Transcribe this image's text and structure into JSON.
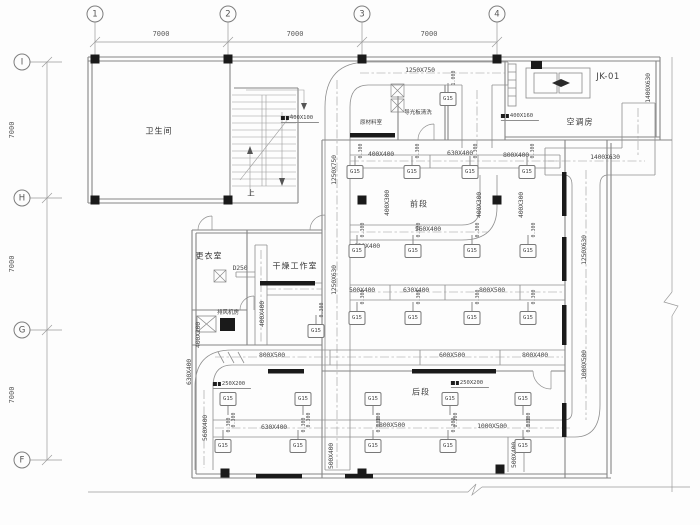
{
  "drawing": {
    "grid": {
      "top_bubbles": [
        {
          "label": "1",
          "x": 95
        },
        {
          "label": "2",
          "x": 228
        },
        {
          "label": "3",
          "x": 362
        },
        {
          "label": "4",
          "x": 497
        }
      ],
      "left_bubbles": [
        {
          "label": "I",
          "y": 62
        },
        {
          "label": "H",
          "y": 198
        },
        {
          "label": "G",
          "y": 330
        },
        {
          "label": "F",
          "y": 460
        }
      ],
      "top_dims": [
        {
          "text": "7000",
          "x": 161,
          "y": 34
        },
        {
          "text": "7000",
          "x": 295,
          "y": 34
        },
        {
          "text": "7000",
          "x": 429,
          "y": 34
        }
      ],
      "left_dims": [
        {
          "text": "7000",
          "x": 12,
          "y": 130
        },
        {
          "text": "7000",
          "x": 12,
          "y": 264
        },
        {
          "text": "7000",
          "x": 12,
          "y": 395
        }
      ]
    },
    "room_labels": [
      {
        "text": "卫生间",
        "x": 159,
        "y": 131,
        "small": false
      },
      {
        "text": "原材料室",
        "x": 371,
        "y": 122,
        "small": true
      },
      {
        "text": "导光板清洗",
        "x": 418,
        "y": 112,
        "small": true
      },
      {
        "text": "空调房",
        "x": 580,
        "y": 122,
        "small": false
      },
      {
        "text": "前段",
        "x": 419,
        "y": 204,
        "small": false
      },
      {
        "text": "更衣室",
        "x": 209,
        "y": 256,
        "small": false
      },
      {
        "text": "干燥工作室",
        "x": 295,
        "y": 266,
        "small": false
      },
      {
        "text": "后段",
        "x": 421,
        "y": 392,
        "small": false
      },
      {
        "text": "排风机房",
        "x": 228,
        "y": 312,
        "small": true
      }
    ],
    "equipment_labels": [
      {
        "text": "JK-01",
        "x": 608,
        "y": 77
      }
    ],
    "stair_label": {
      "text": "上",
      "x": 251,
      "y": 193
    },
    "duct_labels": [
      {
        "text": "1250X750",
        "x": 420,
        "y": 70,
        "rot": 0
      },
      {
        "text": "1250X750",
        "x": 334,
        "y": 170,
        "rot": -90
      },
      {
        "text": "1250X630",
        "x": 334,
        "y": 280,
        "rot": -90
      },
      {
        "text": "400X400",
        "x": 381,
        "y": 154,
        "rot": 0
      },
      {
        "text": "630X400",
        "x": 460,
        "y": 153,
        "rot": 0
      },
      {
        "text": "800X400",
        "x": 516,
        "y": 155,
        "rot": 0
      },
      {
        "text": "1400X630",
        "x": 605,
        "y": 157,
        "rot": 0
      },
      {
        "text": "1400X630",
        "x": 648,
        "y": 88,
        "rot": -90
      },
      {
        "text": "400X300",
        "x": 387,
        "y": 203,
        "rot": -90
      },
      {
        "text": "400X300",
        "x": 479,
        "y": 205,
        "rot": -90
      },
      {
        "text": "400X300",
        "x": 521,
        "y": 205,
        "rot": -90
      },
      {
        "text": "630X400",
        "x": 367,
        "y": 246,
        "rot": 0
      },
      {
        "text": "560X400",
        "x": 428,
        "y": 229,
        "rot": 0
      },
      {
        "text": "1250X630",
        "x": 584,
        "y": 250,
        "rot": -90
      },
      {
        "text": "500X400",
        "x": 362,
        "y": 290,
        "rot": 0
      },
      {
        "text": "630X400",
        "x": 416,
        "y": 290,
        "rot": 0
      },
      {
        "text": "800X500",
        "x": 492,
        "y": 290,
        "rot": 0
      },
      {
        "text": "800X500",
        "x": 272,
        "y": 355,
        "rot": 0
      },
      {
        "text": "600X500",
        "x": 452,
        "y": 355,
        "rot": 0
      },
      {
        "text": "800X400",
        "x": 535,
        "y": 355,
        "rot": 0
      },
      {
        "text": "630X400",
        "x": 189,
        "y": 372,
        "rot": -90
      },
      {
        "text": "560X400",
        "x": 205,
        "y": 428,
        "rot": -90
      },
      {
        "text": "630X400",
        "x": 274,
        "y": 427,
        "rot": 0
      },
      {
        "text": "800X500",
        "x": 392,
        "y": 425,
        "rot": 0
      },
      {
        "text": "1000X500",
        "x": 492,
        "y": 426,
        "rot": 0
      },
      {
        "text": "1000X500",
        "x": 584,
        "y": 365,
        "rot": -90
      },
      {
        "text": "500X400",
        "x": 331,
        "y": 456,
        "rot": -90
      },
      {
        "text": "500X400",
        "x": 514,
        "y": 455,
        "rot": -90
      },
      {
        "text": "400X400",
        "x": 262,
        "y": 314,
        "rot": -90
      },
      {
        "text": "400X200",
        "x": 198,
        "y": 335,
        "rot": -90
      },
      {
        "text": "D250",
        "x": 240,
        "y": 268,
        "rot": 0
      }
    ],
    "tags": [
      {
        "text": "400X100",
        "x": 300,
        "y": 119
      },
      {
        "text": "400X160",
        "x": 520,
        "y": 117
      },
      {
        "text": "250X200",
        "x": 232,
        "y": 385
      },
      {
        "text": "250X200",
        "x": 470,
        "y": 384
      }
    ],
    "diffusers": {
      "label": "G15",
      "rows": [
        {
          "y": 172,
          "stem": "up",
          "flow": "0.300",
          "xs": [
            355,
            412,
            470,
            527
          ]
        },
        {
          "y": 251,
          "stem": "up",
          "flow": "0.300",
          "xs": [
            357,
            413,
            472,
            528
          ]
        },
        {
          "y": 318,
          "stem": "up",
          "flow": "0.300",
          "xs": [
            357,
            413,
            472,
            528
          ]
        },
        {
          "y": 399,
          "stem": "down",
          "flow": "0.300",
          "xs": [
            228,
            303,
            373,
            450,
            523
          ]
        },
        {
          "y": 446,
          "stem": "up",
          "flow": "0.300",
          "xs": [
            223,
            298,
            373,
            448,
            523
          ]
        }
      ],
      "singles": [
        {
          "x": 448,
          "y": 99,
          "flow": "1.000",
          "stem": "up"
        },
        {
          "x": 316,
          "y": 331,
          "flow": "0.300",
          "stem": "up"
        }
      ]
    },
    "colors": {
      "line": "#8e8e8e",
      "wall": "#858585",
      "text": "#4a4a4a",
      "fill": "#1a1a1a"
    }
  }
}
